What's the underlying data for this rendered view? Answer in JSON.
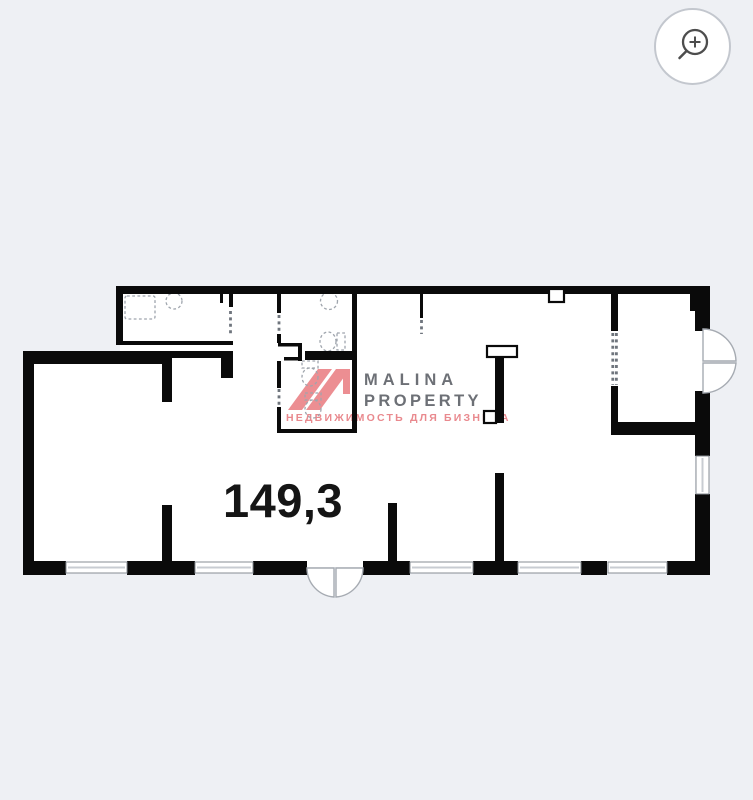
{
  "viewer": {
    "background_color": "#eef0f4",
    "zoom_button": {
      "icon": "magnifier-plus"
    }
  },
  "floor_plan": {
    "area_label": "149,3",
    "wall_color": "#0a0a0a",
    "interior_color": "#ffffff",
    "features": {
      "windows_count": 6,
      "entrance_doors": [
        "double-swing-door-right",
        "double-swing-door-bottom"
      ],
      "fixtures": [
        "shower-tray",
        "washbasin",
        "washbasin",
        "toilet",
        "toilet",
        "toilet"
      ],
      "rooms": [
        "main-hall",
        "left-room",
        "bathroom",
        "wc",
        "vestibule"
      ]
    }
  },
  "watermark": {
    "brand_line1": "MALINA",
    "brand_line2": "PROPERTY",
    "tagline": "НЕДВИЖИМОСТЬ ДЛЯ БИЗНЕСА",
    "accent_color": "#ec8e92",
    "brand_text_color": "#6d7076"
  }
}
